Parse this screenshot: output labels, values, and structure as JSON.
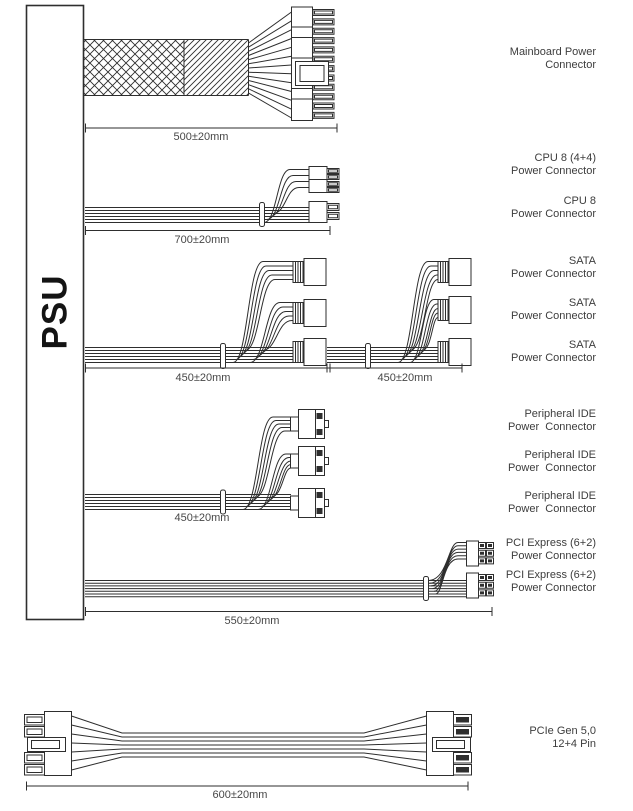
{
  "psu": {
    "label": "PSU"
  },
  "colors": {
    "line": "#2e2e2e",
    "label_text": "#3d3d3d",
    "dim_text": "#474747",
    "background": "#ffffff"
  },
  "connector_labels": [
    {
      "line1": "Mainboard Power",
      "line2": "Connector"
    },
    {
      "line1": "CPU 8 (4+4)",
      "line2": "Power Connector"
    },
    {
      "line1": "CPU 8",
      "line2": "Power Connector"
    },
    {
      "line1": "SATA",
      "line2": "Power Connector"
    },
    {
      "line1": "SATA",
      "line2": "Power Connector"
    },
    {
      "line1": "SATA",
      "line2": "Power Connector"
    },
    {
      "line1": "Peripheral IDE",
      "line2": "Power  Connector"
    },
    {
      "line1": "Peripheral IDE",
      "line2": "Power  Connector"
    },
    {
      "line1": "Peripheral IDE",
      "line2": "Power  Connector"
    },
    {
      "line1": "PCI Express (6+2)",
      "line2": "Power Connector"
    },
    {
      "line1": "PCI Express (6+2)",
      "line2": "Power Connector"
    },
    {
      "line1": "PCIe Gen 5,0",
      "line2": "12+4 Pin"
    }
  ],
  "dimensions": [
    {
      "text": "500±20mm"
    },
    {
      "text": "700±20mm"
    },
    {
      "text": "450±20mm"
    },
    {
      "text": "450±20mm"
    },
    {
      "text": "450±20mm"
    },
    {
      "text": "550±20mm"
    },
    {
      "text": "600±20mm"
    }
  ]
}
